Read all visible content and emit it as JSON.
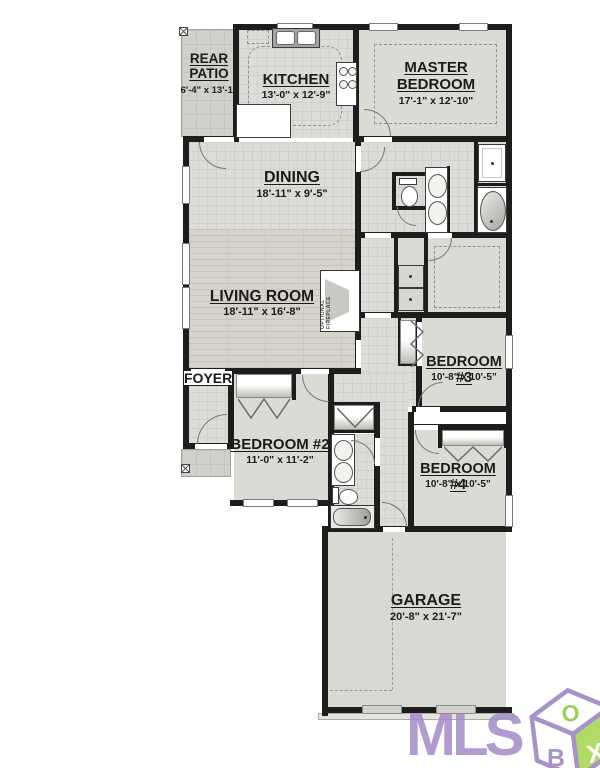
{
  "plan": {
    "rooms": {
      "rear_patio": {
        "name": "REAR PATIO",
        "dims": "6'-4\" x 13'-1\""
      },
      "kitchen": {
        "name": "KITCHEN",
        "dims": "13'-0\" x 12'-9\""
      },
      "master_bedroom": {
        "name": "MASTER BEDROOM",
        "dims": "17'-1\" x 12'-10\""
      },
      "dining": {
        "name": "DINING",
        "dims": "18'-11\" x 9'-5\""
      },
      "living_room": {
        "name": "LIVING ROOM",
        "dims": "18'-11\" x 16'-8\""
      },
      "foyer": {
        "name": "FOYER"
      },
      "bedroom_2": {
        "name": "BEDROOM #2",
        "dims": "11'-0\" x 11'-2\""
      },
      "bedroom_3": {
        "name": "BEDROOM #3",
        "dims": "10'-8\" x 10'-5\""
      },
      "bedroom_4": {
        "name": "BEDROOM #4",
        "dims": "10'-8\" x 10'-5\""
      },
      "garage": {
        "name": "GARAGE",
        "dims": "20'-8\" x 21'-7\""
      }
    },
    "annotations": {
      "optional_fireplace": "OPTIONAL FIREPLACE"
    },
    "colors": {
      "wall": "#1d1d1d",
      "floor": "#dbdbd6",
      "tile": "#dcdcd8",
      "logo_purple": "#a58bc7",
      "logo_green": "#a4d54e"
    }
  },
  "watermark": {
    "text": "MLS",
    "cube_top": "O",
    "cube_left": "B",
    "cube_right": "X"
  }
}
